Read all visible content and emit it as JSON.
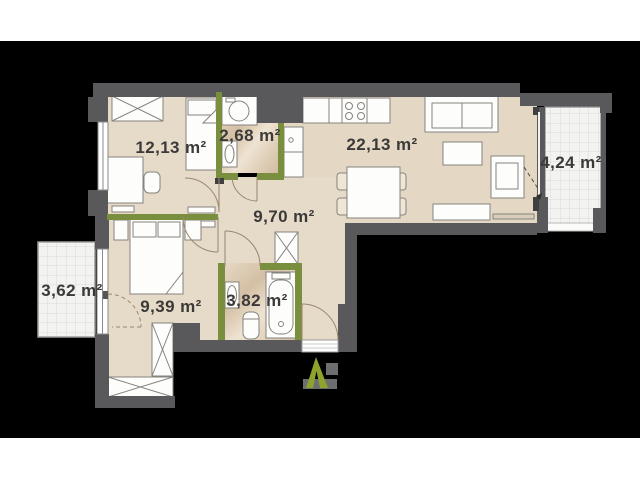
{
  "floorplan": {
    "type": "apartment-floor-plan",
    "rooms": [
      {
        "id": "room-12",
        "area_label": "12,13 m²"
      },
      {
        "id": "wc",
        "area_label": "2,68 m²"
      },
      {
        "id": "living-kitchen",
        "area_label": "22,13 m²"
      },
      {
        "id": "balcony-right",
        "area_label": "4,24 m²"
      },
      {
        "id": "hall",
        "area_label": "9,70 m²"
      },
      {
        "id": "balcony-left",
        "area_label": "3,62 m²"
      },
      {
        "id": "bedroom",
        "area_label": "9,39 m²"
      },
      {
        "id": "bathroom",
        "area_label": "3,82 m²"
      }
    ],
    "colors": {
      "background": "#000000",
      "page_band": "#ffffff",
      "wall": "#59595b",
      "partition_green": "#7a8f3d",
      "floor_beige": "#e6dac8",
      "floor_marble": "#d9c6ae",
      "balcony_floor": "#f3f3f2",
      "label_text": "#3b3a38",
      "logo_green": "#8ea32e",
      "logo_grey": "#6d6e70"
    }
  }
}
